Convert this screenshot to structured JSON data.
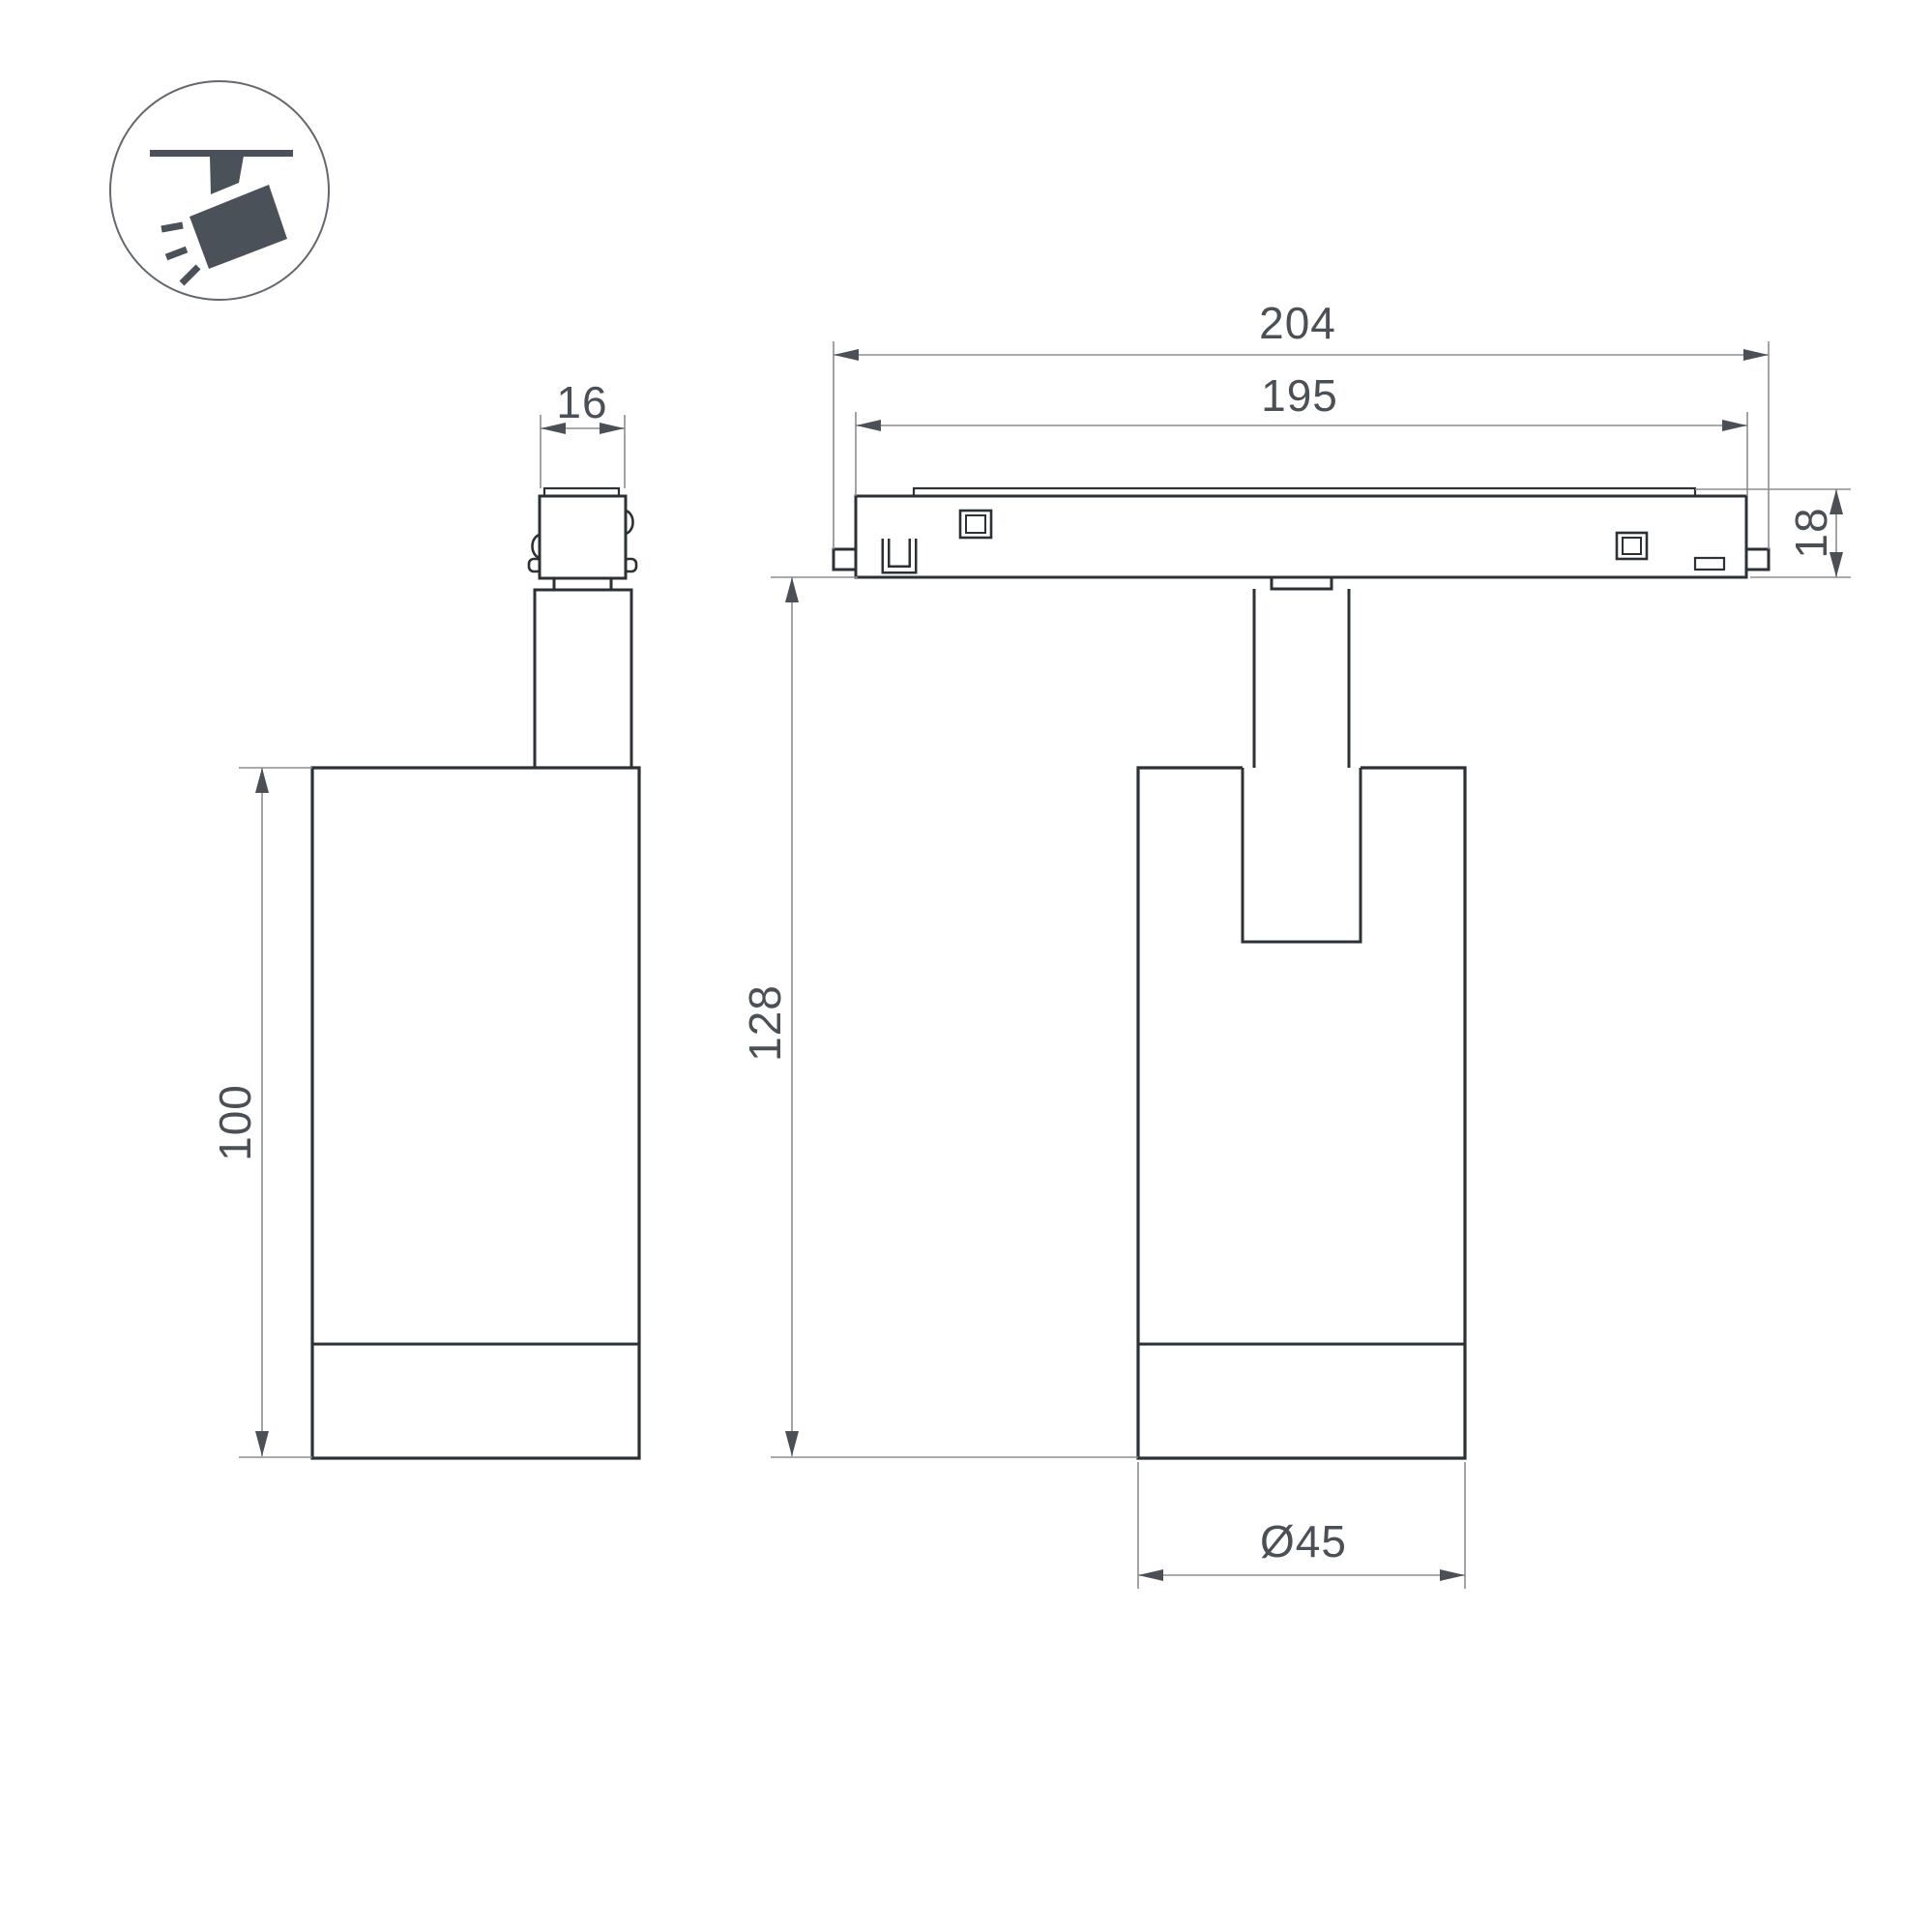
{
  "drawing": {
    "kind": "luminaire dimension drawing",
    "views": [
      "side view",
      "front view"
    ],
    "dims": {
      "d16": {
        "label": "16"
      },
      "d100": {
        "label": "100"
      },
      "d204": {
        "label": "204"
      },
      "d195": {
        "label": "195"
      },
      "d18": {
        "label": "18"
      },
      "d128": {
        "label": "128"
      },
      "d45": {
        "label": "Ø45"
      }
    }
  },
  "icon": {
    "name": "track-spotlight-icon"
  },
  "colors": {
    "object-line": "#2c3135",
    "dim-line": "#8b8e91",
    "accent-text": "#4a5056",
    "icon-fill": "#4a5158",
    "background": "#ffffff"
  }
}
